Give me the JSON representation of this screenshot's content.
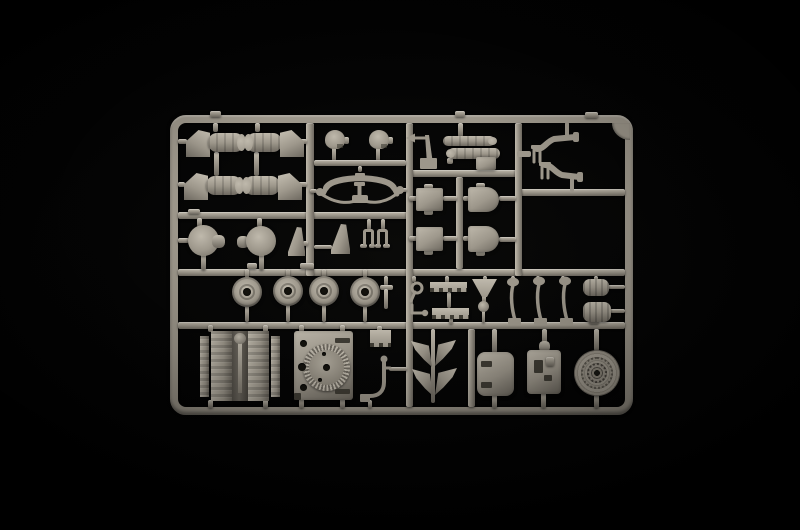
{
  "scene": {
    "subject": "Grey injection-molded plastic model kit sprue (parts runner) photographed on a black background",
    "colors": {
      "background": "#020202",
      "plastic": "#9d978b",
      "plastic_light": "#bfb9ac",
      "plastic_dark": "#6e6960",
      "plastic_deep": "#403d35",
      "hole": "#14130e"
    }
  },
  "inventory": {
    "exhaust_cowls": 4,
    "drums": 2,
    "road_wheels": 4,
    "hatch_panels": 4,
    "exhaust_pipes": 2,
    "mud_flaps": 4,
    "engine_blocks": 1,
    "fan_deck_plates": 1,
    "idler_wheels": 1
  },
  "part_titles": {
    "frame": "Sprue runner frame",
    "muffler": "Exhaust cowl with pipe section",
    "drum": "Cylindrical housing",
    "blade_bracket": "Curved blade bracket",
    "dome": "Domed cap",
    "sway_bar": "Curved linkage bar with tow cable",
    "antenna": "Antenna mount with pointer",
    "fuel_tank": "Twin stacked cylinder tank",
    "exhaust_pipe": "S-shaped exhaust pipe pair",
    "square_hatch": "Square hatch panel",
    "round_hatch": "Round-edged hatch panel",
    "road_wheel": "Road wheel with hub",
    "pin": "Capped pin",
    "hook": "Tow hook and shackle",
    "step_strip": "Notched step strip",
    "funnel": "Funnel mount with ball joint",
    "lever": "Curved lever arm",
    "pump": "Ribbed cylinder assembly",
    "engine": "V-type engine block",
    "fan_plate": "Engine deck plate with toothed cooling fan",
    "vent_block": "Vented block",
    "bent_bracket": "Bent bracket arm",
    "mud_flap": "Curved mud flap",
    "hatch_box": "Rounded hatch box",
    "turret_box": "Detailed housing block",
    "idler_wheel": "Ribbed idler wheel",
    "goalpost": "Small frame bracket",
    "corner_gusset": "Corner gusset"
  }
}
